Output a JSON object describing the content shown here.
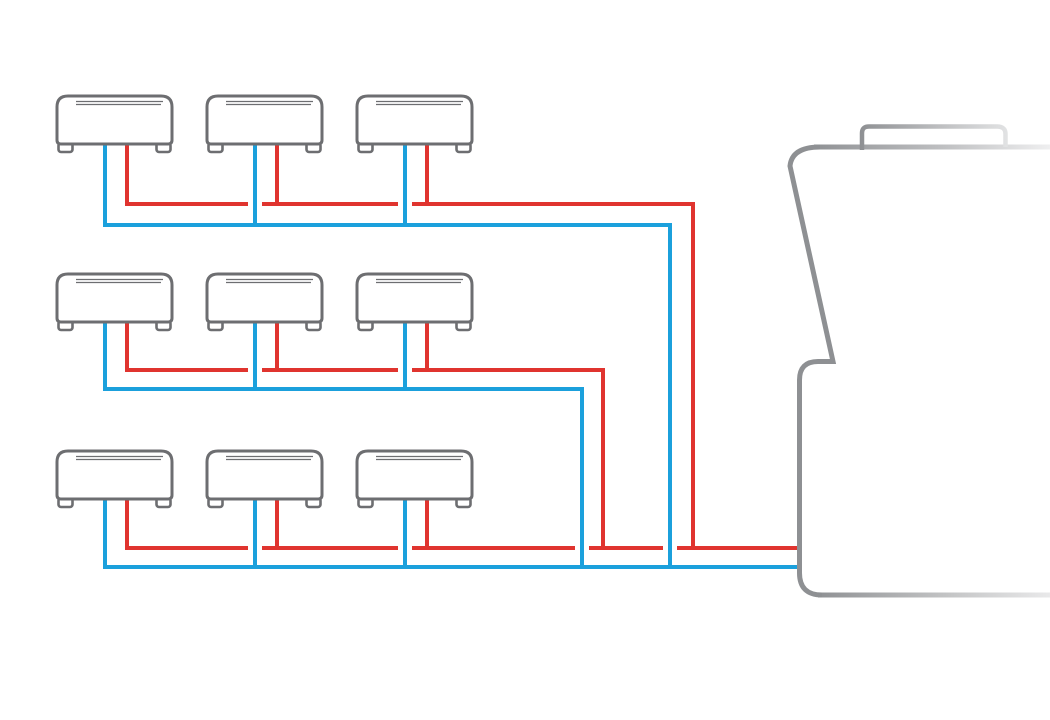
{
  "page": {
    "background": "#FFFFFF",
    "width": 1050,
    "height": 720
  },
  "diagram": {
    "type": "hvac-multi-split-refrigerant-piping",
    "description": "nine-indoor-units-three-rows-connected-by-red-and-blue-lines-to-one-outdoor-unit",
    "colors": {
      "indoor_unit_stroke": "#6D6E71",
      "outdoor_unit_stroke": "#8E9093",
      "outdoor_unit_fade": "#EFEFF0",
      "liquid_line_red": "#E0342F",
      "suction_line_blue": "#1BA0DC",
      "background": "#FFFFFF"
    },
    "indoor_units": {
      "rows": 3,
      "cols": 3,
      "cols_x": [
        57,
        207,
        357
      ],
      "rows_y": [
        96,
        274,
        451
      ],
      "width": 115,
      "body_height": 48,
      "foot_width": 14,
      "foot_height": 8,
      "blue_pipe_offset": 48,
      "red_pipe_offset": 70,
      "vent_line_count": 2
    },
    "pipe_rows": [
      {
        "red_y": 204,
        "blue_y": 225,
        "red_end_x": 693,
        "blue_end_x": 670,
        "has_trunk": true,
        "red_gap_xs": [
          255,
          405
        ]
      },
      {
        "red_y": 370,
        "blue_y": 389,
        "red_end_x": 603,
        "blue_end_x": 582,
        "has_trunk": true,
        "red_gap_xs": [
          255,
          405
        ]
      },
      {
        "red_y": 548,
        "blue_y": 567,
        "red_end_x": 797,
        "blue_end_x": 797,
        "has_trunk": false,
        "red_gap_xs": [
          255,
          405,
          582,
          670
        ]
      }
    ],
    "trunk_red_end_y": 548,
    "trunk_blue_end_y": 567,
    "pipe_width": 4,
    "gap_half_width": 7,
    "outdoor_unit": {
      "stroke_width": 5,
      "tab_stroke_width": 4.5,
      "top_line": {
        "x1": 814,
        "y": 147,
        "x2": 1050
      },
      "bottom_line": {
        "x1": 818,
        "y": 595,
        "x2": 1050
      },
      "left_path": "M 820,147 Q 792,147 790,166 L 833,361.5 L 818,361.5 Q 799.5,361.5 799.5,380 L 799.5,573 Q 799.5,595 822,595",
      "tab_path": "M 862,150 L 862,133 Q 862,126.5 869,126.5 L 997,126.5 Q 1005.5,126.5 1005.5,134 L 1005.5,147",
      "gradients": {
        "top": {
          "x1": 810,
          "x2": 1050,
          "stops": [
            "#8E9093",
            "#BEBFC1",
            "#EFEFF0"
          ]
        },
        "bottom": {
          "x1": 815,
          "x2": 1050,
          "stops": [
            "#8E9093",
            "#C2C3C4",
            "#E9E9EA"
          ]
        },
        "tab": {
          "x1": 860,
          "x2": 1010,
          "stops": [
            "#8E9093",
            "#BFC0C2",
            "#E3E4E5"
          ]
        }
      }
    }
  }
}
